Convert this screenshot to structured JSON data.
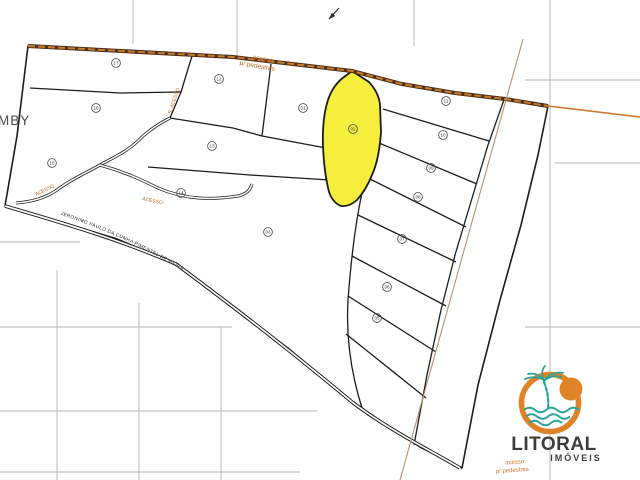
{
  "map": {
    "region_label_partial": "MBY",
    "top_access_label_line1": "acesso",
    "top_access_label_line2": "p/ pedestres",
    "bottom_access_label_line1": "acesso",
    "bottom_access_label_line2": "p/ pedestres",
    "road_name": "JERONIMO PAULO DA CUNHA PIMENTEL DE MEIRA",
    "street_labels": [
      "R. ACESSO",
      "ACESSO",
      "ACESSO"
    ],
    "highlighted_lot": "02",
    "highlight_color": "#F6EE3C",
    "road_color": "#C97B2D",
    "label_color": "#C06820",
    "lots": [
      {
        "num": "17",
        "x": 116,
        "y": 63
      },
      {
        "num": "16",
        "x": 96,
        "y": 108
      },
      {
        "num": "15",
        "x": 52,
        "y": 163
      },
      {
        "num": "14",
        "x": 181,
        "y": 193
      },
      {
        "num": "13",
        "x": 212,
        "y": 146
      },
      {
        "num": "12",
        "x": 219,
        "y": 79
      },
      {
        "num": "01",
        "x": 303,
        "y": 108
      },
      {
        "num": "02",
        "x": 353,
        "y": 129
      },
      {
        "num": "03",
        "x": 268,
        "y": 232
      },
      {
        "num": "11",
        "x": 446,
        "y": 101
      },
      {
        "num": "10",
        "x": 443,
        "y": 135
      },
      {
        "num": "09",
        "x": 431,
        "y": 168
      },
      {
        "num": "08",
        "x": 418,
        "y": 197
      },
      {
        "num": "07",
        "x": 402,
        "y": 239
      },
      {
        "num": "06",
        "x": 387,
        "y": 287
      },
      {
        "num": "05",
        "x": 377,
        "y": 318
      }
    ]
  },
  "logo": {
    "name": "LITORAL",
    "subtitle": "IMÓVEIS",
    "orange": "#E08226",
    "teal": "#2BA397",
    "dark": "#3D3D3D"
  }
}
